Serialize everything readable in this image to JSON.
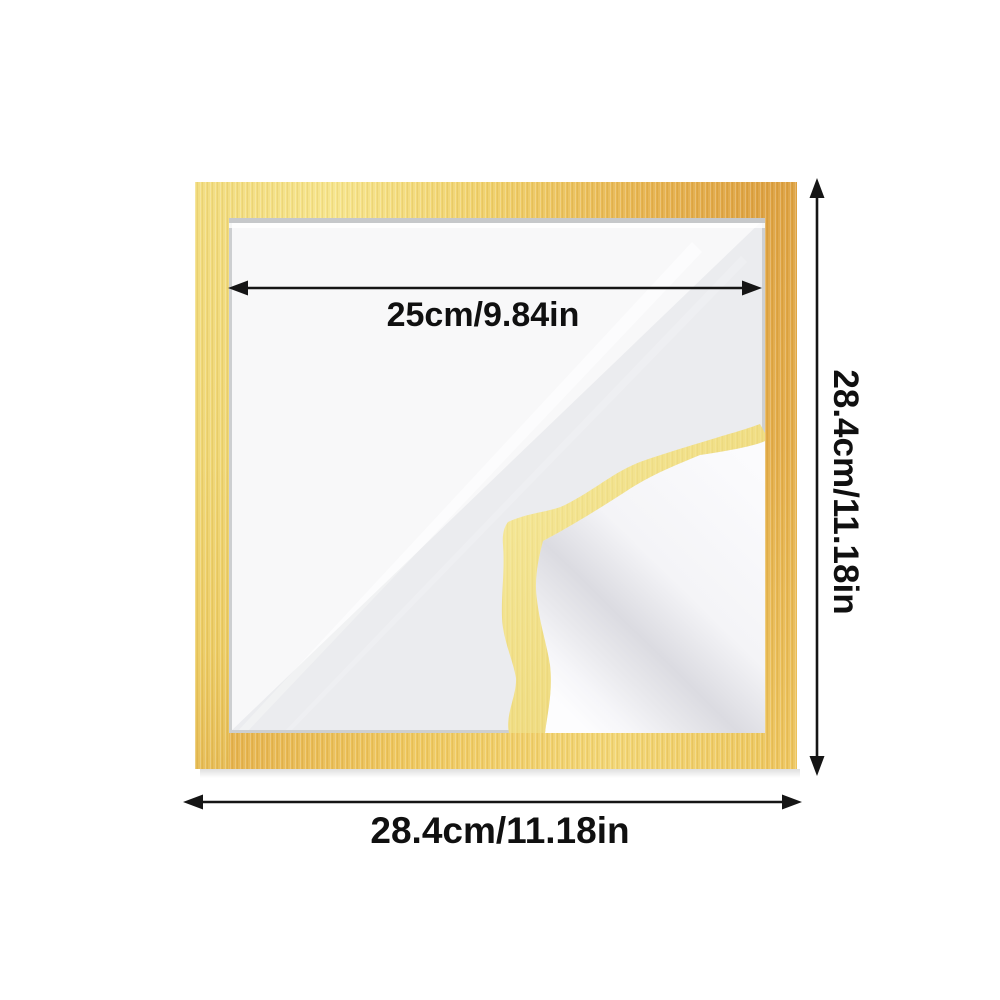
{
  "image": {
    "description": "Gold square self-adhesive picture frame with protective film peeled back at one corner, annotated with dimensions",
    "background_color": "#FFFFFF"
  },
  "frame": {
    "gold_light": "#F6E489",
    "gold_mid": "#EFCE66",
    "gold_dark": "#DDA03E",
    "film_band_gold": "#F0DD82",
    "window_color": "#F3F3F5"
  },
  "annotations": {
    "arrow_color": "#151515",
    "inner_width_label": "25cm/9.84in",
    "height_label": "28.4cm/11.18in",
    "outer_width_label": "28.4cm/11.18in"
  }
}
